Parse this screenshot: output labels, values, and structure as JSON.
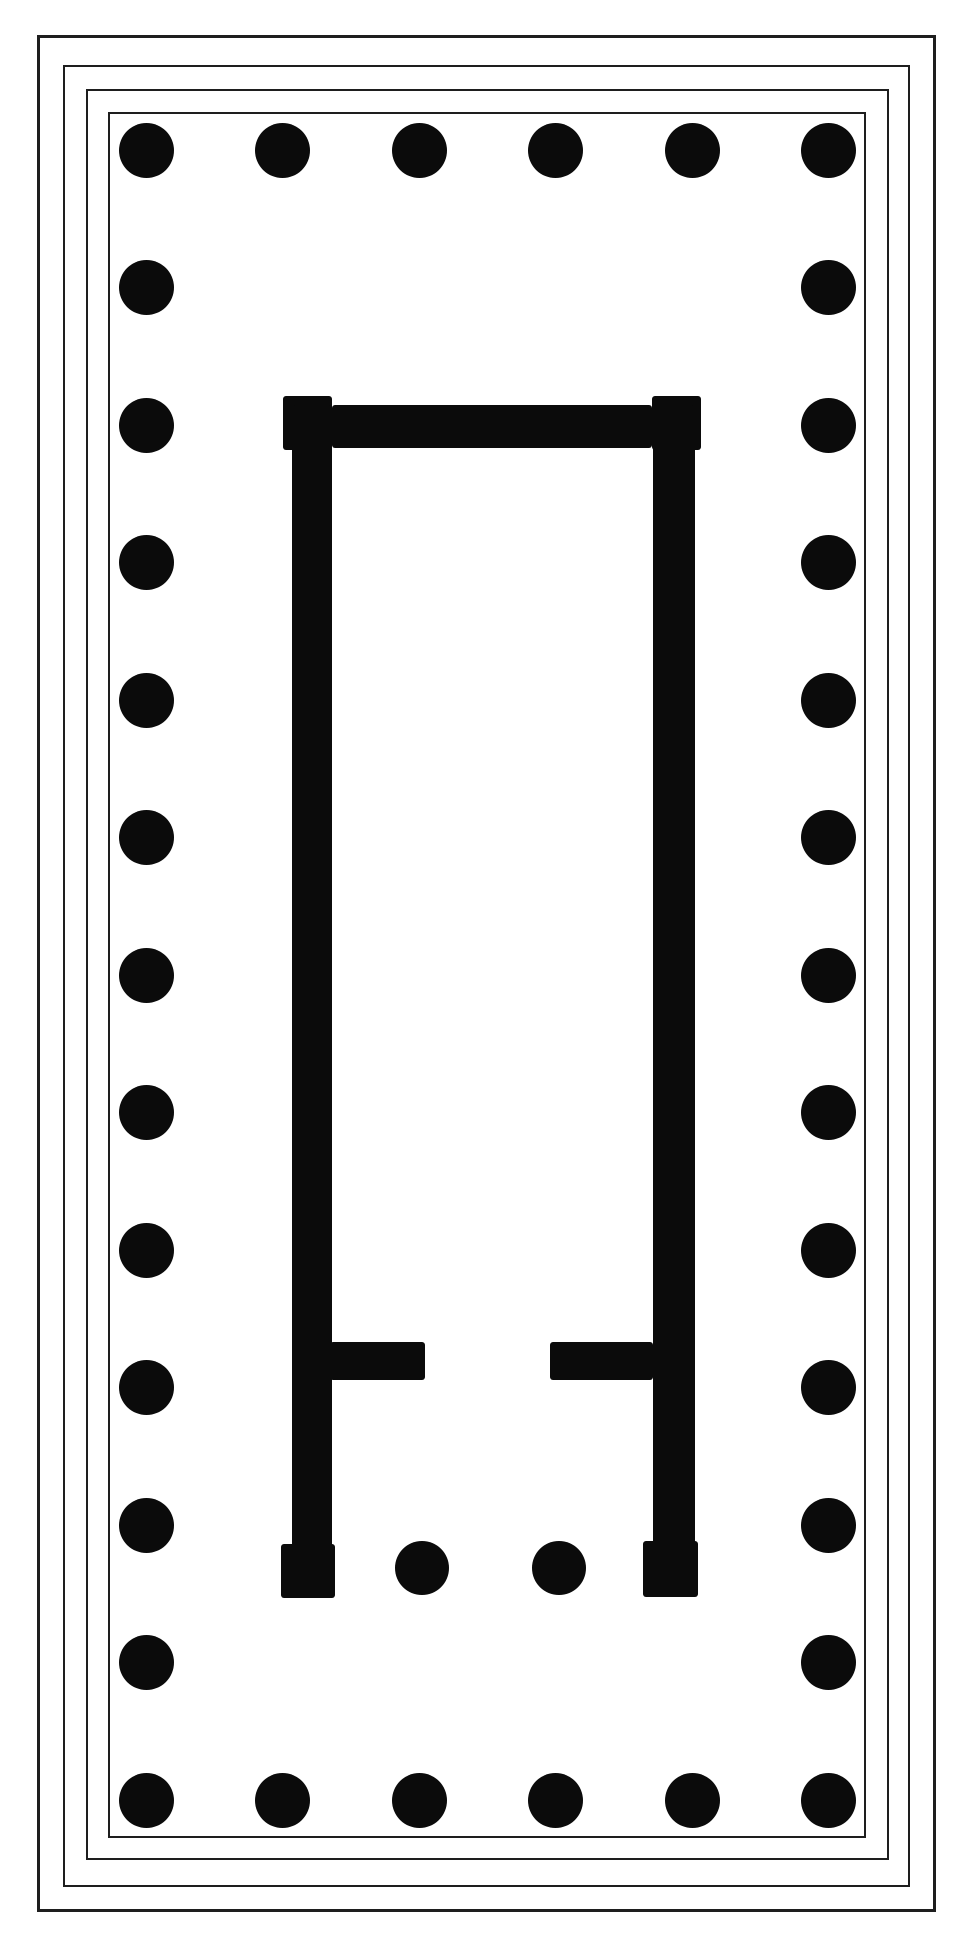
{
  "figure": {
    "type": "temple-floor-plan",
    "front_column_count": 6,
    "flank_column_count": 13,
    "peristyle_column_count": 34,
    "in_antis_column_count": 2,
    "anta_count": 4,
    "step_count": 4
  },
  "canvas": {
    "width": 968,
    "height": 1945,
    "background": "#ffffff",
    "ink": "#0b0b0b",
    "line_color": "#1e1e1e"
  },
  "platform": {
    "steps": [
      {
        "name": "step-rect-outer",
        "x": 37,
        "y": 35,
        "w": 899,
        "h": 1877,
        "stroke": 3
      },
      {
        "name": "step-rect-second",
        "x": 63,
        "y": 65,
        "w": 847,
        "h": 1822,
        "stroke": 2
      },
      {
        "name": "step-rect-third",
        "x": 86,
        "y": 89,
        "w": 803,
        "h": 1771,
        "stroke": 2
      },
      {
        "name": "step-rect-stylobate",
        "x": 108,
        "y": 112,
        "w": 758,
        "h": 1726,
        "stroke": 2
      }
    ]
  },
  "peristyle": {
    "column_radius": 27.5,
    "cols_x": [
      146,
      282,
      419,
      555,
      692,
      828
    ],
    "rows_y": [
      150,
      287,
      425,
      562,
      700,
      837,
      975,
      1112,
      1250,
      1387,
      1525,
      1662,
      1800
    ]
  },
  "cella": {
    "walls": [
      {
        "name": "cella-north-wall",
        "x": 332,
        "y": 405,
        "w": 320,
        "h": 43
      },
      {
        "name": "anta-northwest",
        "x": 283,
        "y": 396,
        "w": 49,
        "h": 54
      },
      {
        "name": "anta-northeast",
        "x": 652,
        "y": 396,
        "w": 49,
        "h": 54
      },
      {
        "name": "cella-west-wall",
        "x": 292,
        "y": 405,
        "w": 40,
        "h": 1192
      },
      {
        "name": "cella-east-wall",
        "x": 653,
        "y": 405,
        "w": 42,
        "h": 1192
      },
      {
        "name": "pronaos-spur-wall-west",
        "x": 330,
        "y": 1342,
        "w": 95,
        "h": 38
      },
      {
        "name": "pronaos-spur-wall-east",
        "x": 550,
        "y": 1342,
        "w": 103,
        "h": 38
      },
      {
        "name": "anta-southwest",
        "x": 281,
        "y": 1544,
        "w": 54,
        "h": 54
      },
      {
        "name": "anta-southeast",
        "x": 643,
        "y": 1541,
        "w": 55,
        "h": 56
      }
    ],
    "in_antis_columns": {
      "radius": 27,
      "y": 1568,
      "x": [
        422,
        559
      ]
    }
  }
}
